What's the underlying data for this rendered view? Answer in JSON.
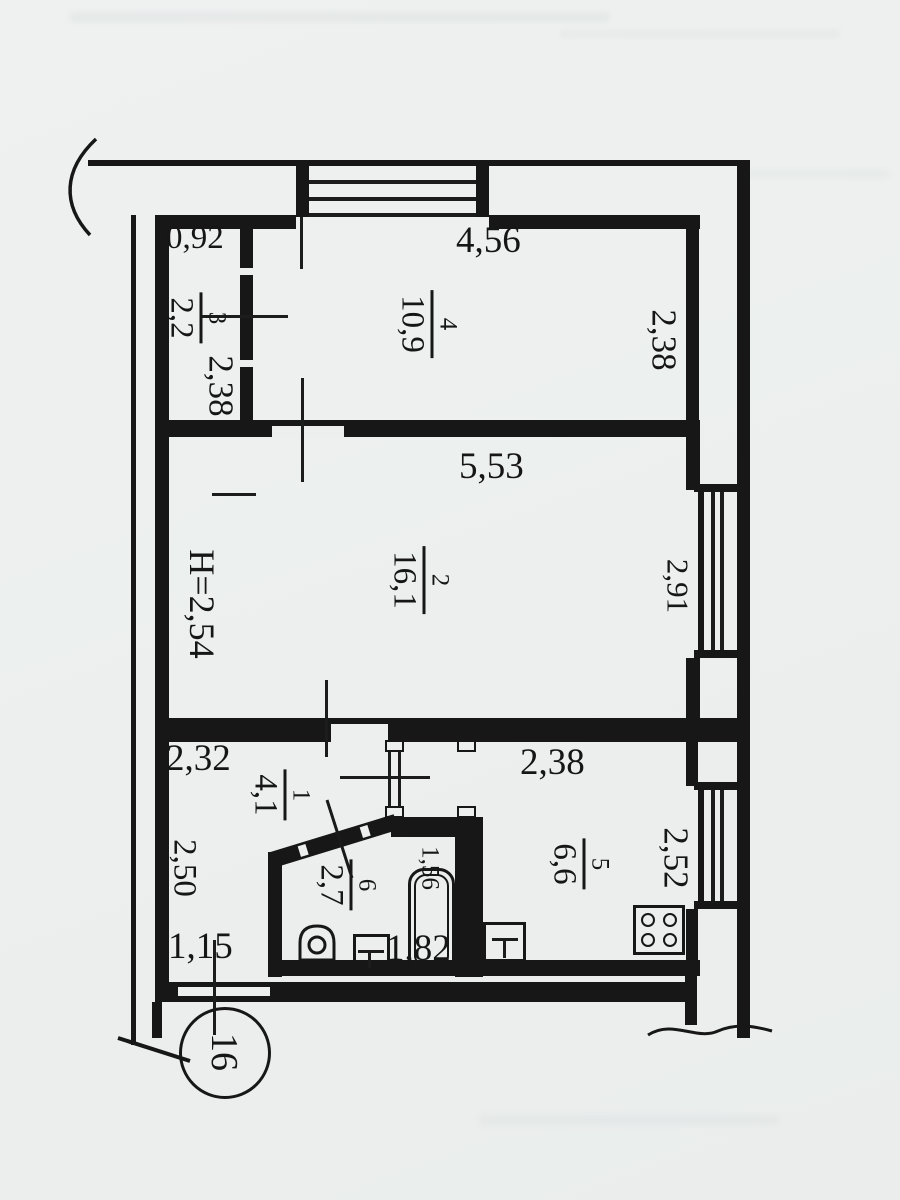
{
  "floorplan": {
    "unit_circle": "16",
    "ceiling_height": "H=2,54",
    "rooms": [
      {
        "number": "4",
        "area": "10,9",
        "width": "4,56",
        "depth": "2,38"
      },
      {
        "number": "3",
        "area": "2,2",
        "width": "0,92",
        "depth": "2,38"
      },
      {
        "number": "2",
        "area": "16,1",
        "width": "5,53",
        "window": "2,91"
      },
      {
        "number": "1",
        "area": "4,1",
        "width": "2,32",
        "depth": "2,50",
        "entry": "1,15"
      },
      {
        "number": "6",
        "area": "2,7",
        "tub": "1,56",
        "length": "1,82"
      },
      {
        "number": "5",
        "area": "6,6",
        "width": "2,38",
        "window": "2,52"
      }
    ]
  }
}
